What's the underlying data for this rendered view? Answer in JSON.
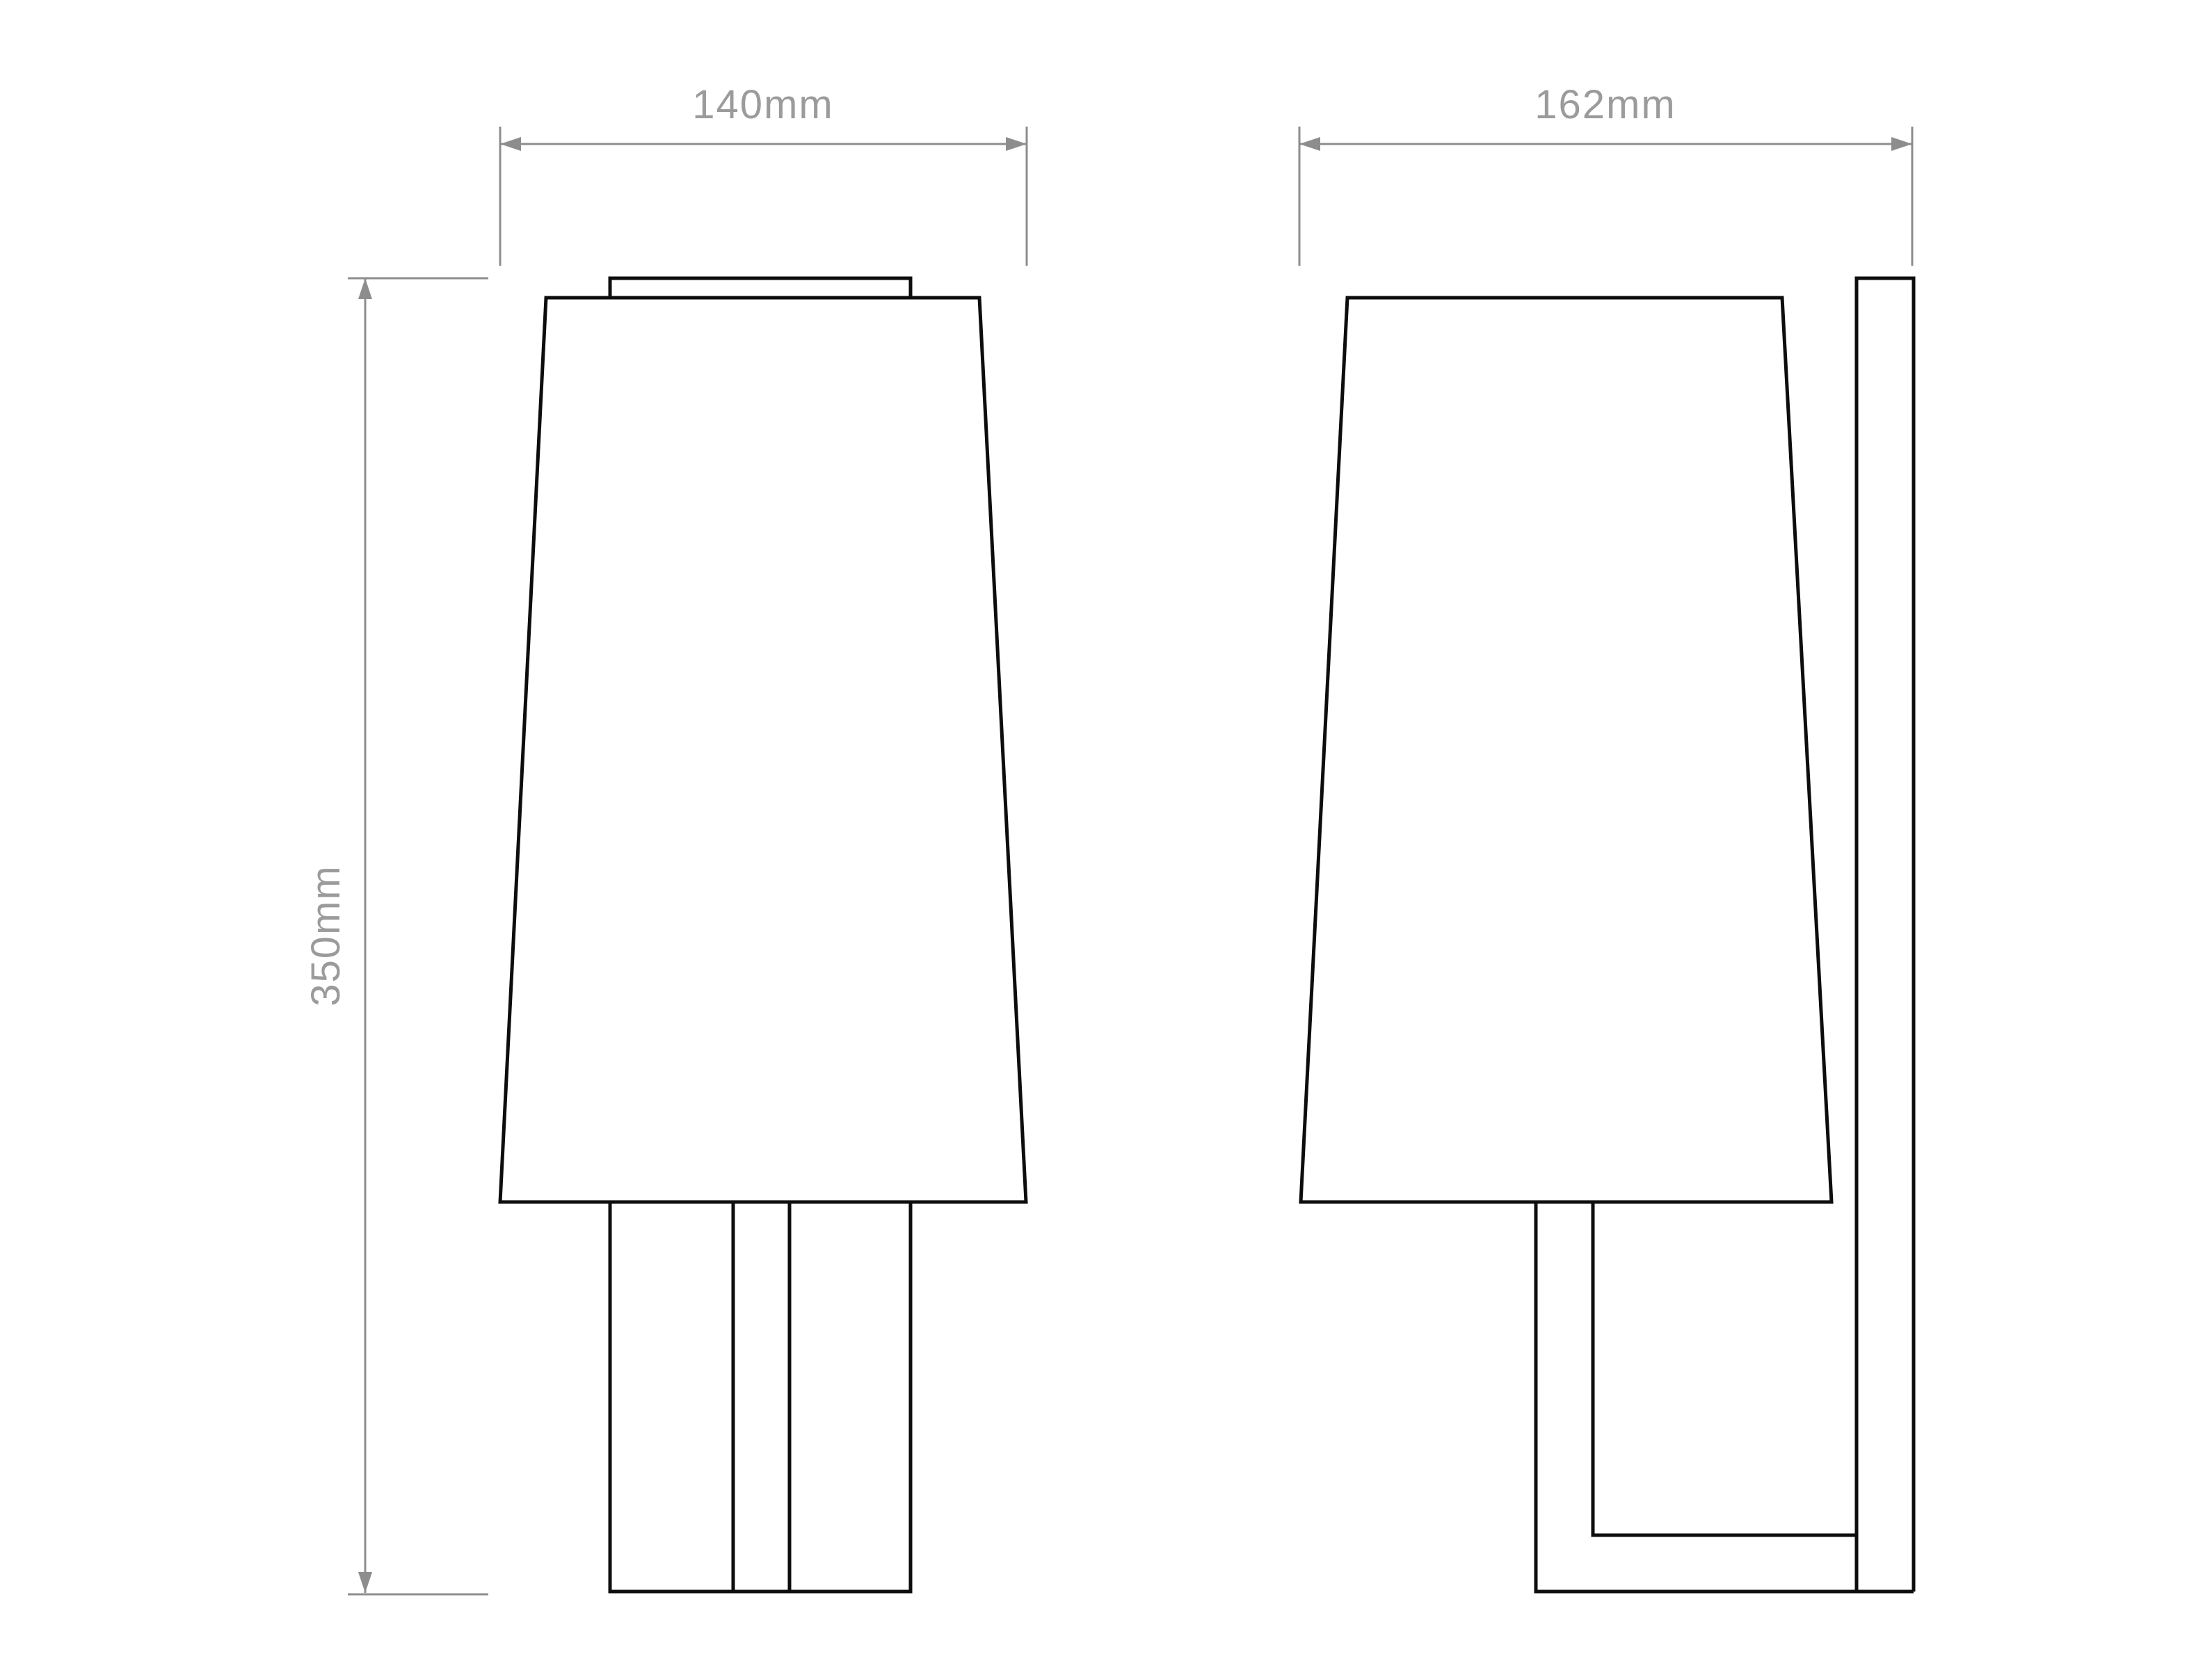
{
  "drawing": {
    "colors": {
      "background": "#ffffff",
      "object_line": "#0d0d0d",
      "dimension_line": "#8d8d8d",
      "dimension_text": "#9b9b9b"
    },
    "dimensions": {
      "width": {
        "label": "140mm"
      },
      "depth": {
        "label": "162mm"
      },
      "height": {
        "label": "350mm"
      }
    }
  }
}
